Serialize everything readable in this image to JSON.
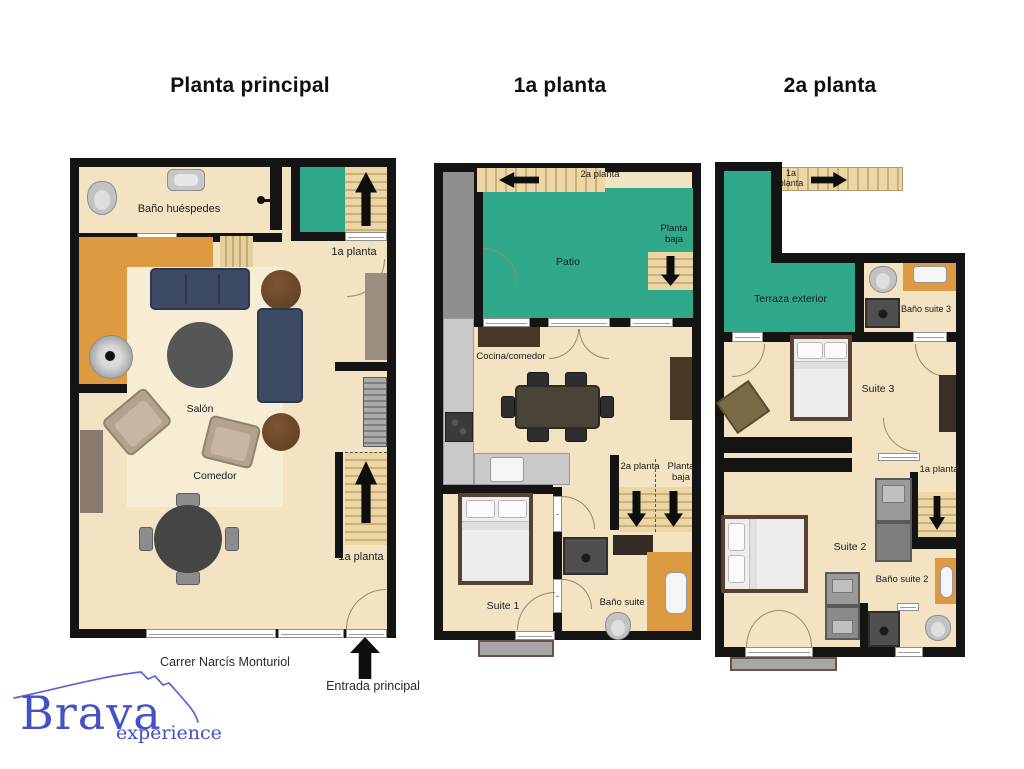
{
  "titles": {
    "main": "Planta principal",
    "first": "1a planta",
    "second": "2a planta"
  },
  "plan_main": {
    "bathroom_label": "Baño huéspedes",
    "stairs_top_label": "1a planta",
    "salon_label": "Salón",
    "comedor_label": "Comedor",
    "stairs_bottom_label": "1a planta",
    "street_label": "Carrer Narcís Monturiol",
    "entrance_label": "Entrada principal"
  },
  "plan_first": {
    "stairs_top_label": "2a planta",
    "patio_label": "Patio",
    "stairs_patio_label": "Planta baja",
    "kitchen_label": "Cocina/comedor",
    "stairs_mid_left_label": "2a planta",
    "stairs_mid_right_label": "Planta baja",
    "suite1_label": "Suite 1",
    "bath1_label": "Baño suite 1"
  },
  "plan_second": {
    "stairs_top_label": "1a planta",
    "terrace_label": "Terraza exterior",
    "bath3_label": "Baño suite 3",
    "suite3_label": "Suite 3",
    "stairs_mid_label": "1a planta",
    "suite2_label": "Suite 2",
    "bath2_label": "Baño suite 2"
  },
  "logo": {
    "brand": "Brava",
    "tagline": "experience"
  },
  "colors": {
    "floor": "#f3e3c2",
    "patio_green": "#2fa98a",
    "accent_orange": "#dd9a41",
    "wall": "#141414",
    "logo_blue": "#4450c5"
  }
}
